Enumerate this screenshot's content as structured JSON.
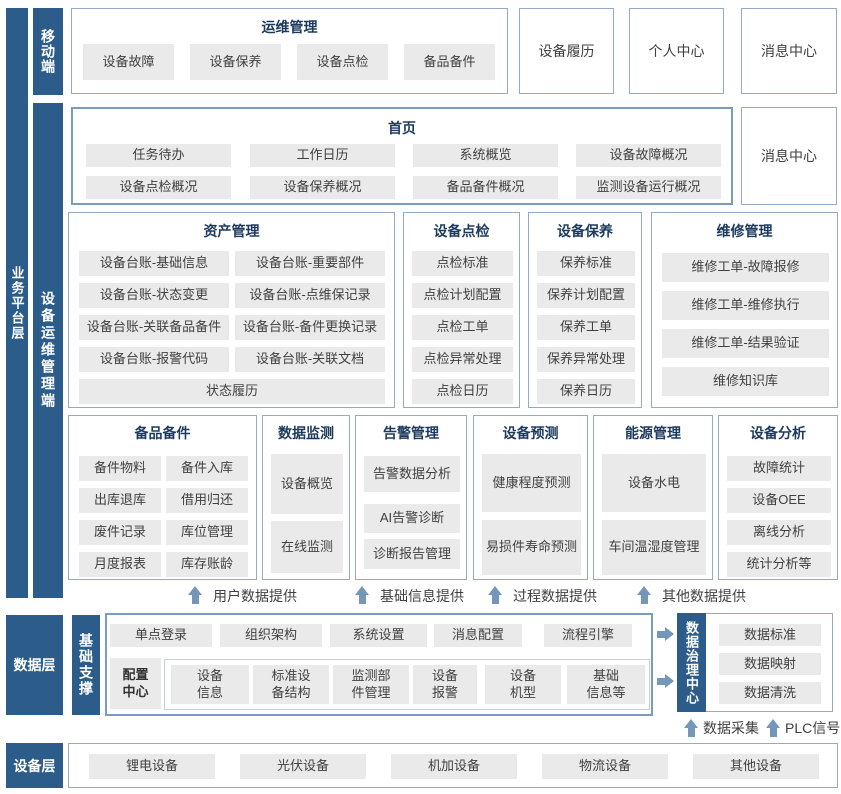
{
  "colors": {
    "bar_blue": "#2b5c8a",
    "box_border": "#93abc4",
    "box_border_strong": "#7b9cbe",
    "item_bg": "#eaeaea",
    "title_navy": "#1d3a5e",
    "arrow_blue": "#7496b8",
    "inner_border": "#c5d0dd",
    "text_dark": "#404040"
  },
  "layers": {
    "business_platform_label": "业务平台层",
    "mobile_label": "移动端",
    "ops_mgmt_label": "设备运维管理端",
    "data_layer_label": "数据层",
    "base_support_label": "基础支撑",
    "device_layer_label": "设备层"
  },
  "mobile": {
    "ops": {
      "title": "运维管理",
      "items": [
        "设备故障",
        "设备保养",
        "设备点检",
        "备品备件"
      ]
    },
    "side_boxes": [
      "设备履历",
      "个人中心",
      "消息中心"
    ]
  },
  "platform": {
    "home": {
      "title": "首页",
      "items": [
        "任务待办",
        "工作日历",
        "系统概览",
        "设备故障概况",
        "设备点检概况",
        "设备保养概况",
        "备品备件概况",
        "监测设备运行概况"
      ]
    },
    "message_center": "消息中心",
    "asset": {
      "title": "资产管理",
      "items": [
        "设备台账-基础信息",
        "设备台账-重要部件",
        "设备台账-状态变更",
        "设备台账-点维保记录",
        "设备台账-关联备品备件",
        "设备台账-备件更换记录",
        "设备台账-报警代码",
        "设备台账-关联文档"
      ],
      "wide_item": "状态履历"
    },
    "inspection": {
      "title": "设备点检",
      "items": [
        "点检标准",
        "点检计划配置",
        "点检工单",
        "点检异常处理",
        "点检日历"
      ]
    },
    "maintenance": {
      "title": "设备保养",
      "items": [
        "保养标准",
        "保养计划配置",
        "保养工单",
        "保养异常处理",
        "保养日历"
      ]
    },
    "repair": {
      "title": "维修管理",
      "items": [
        "维修工单-故障报修",
        "维修工单-维修执行",
        "维修工单-结果验证",
        "维修知识库"
      ]
    },
    "spare": {
      "title": "备品备件",
      "items": [
        "备件物料",
        "备件入库",
        "出库退库",
        "借用归还",
        "废件记录",
        "库位管理",
        "月度报表",
        "库存账龄"
      ]
    },
    "monitor": {
      "title": "数据监测",
      "items": [
        "设备概览",
        "在线监测"
      ]
    },
    "alarm": {
      "title": "告警管理",
      "items": [
        "告警数据分析",
        "AI告警诊断",
        "诊断报告管理"
      ]
    },
    "predict": {
      "title": "设备预测",
      "items": [
        "健康程度预测",
        "易损件寿命预测"
      ]
    },
    "energy": {
      "title": "能源管理",
      "items": [
        "设备水电",
        "车间温湿度管理"
      ]
    },
    "analysis": {
      "title": "设备分析",
      "items": [
        "故障统计",
        "设备OEE",
        "离线分析",
        "统计分析等"
      ]
    },
    "feed_arrows": [
      "用户数据提供",
      "基础信息提供",
      "过程数据提供",
      "其他数据提供"
    ]
  },
  "data_layer": {
    "row1": [
      "单点登录",
      "组织架构",
      "系统设置",
      "消息配置",
      "流程引擎"
    ],
    "config_center": {
      "label": "配置\n中心",
      "items": [
        "设备\n信息",
        "标准设\n备结构",
        "监测部\n件管理",
        "设备\n报警",
        "设备\n机型",
        "基础\n信息等"
      ]
    },
    "governance": {
      "label": "数据治理中心",
      "items": [
        "数据标准",
        "数据映射",
        "数据清洗"
      ]
    },
    "bottom_arrows": [
      "数据采集",
      "PLC信号"
    ]
  },
  "device_layer": {
    "items": [
      "锂电设备",
      "光伏设备",
      "机加设备",
      "物流设备",
      "其他设备"
    ]
  }
}
